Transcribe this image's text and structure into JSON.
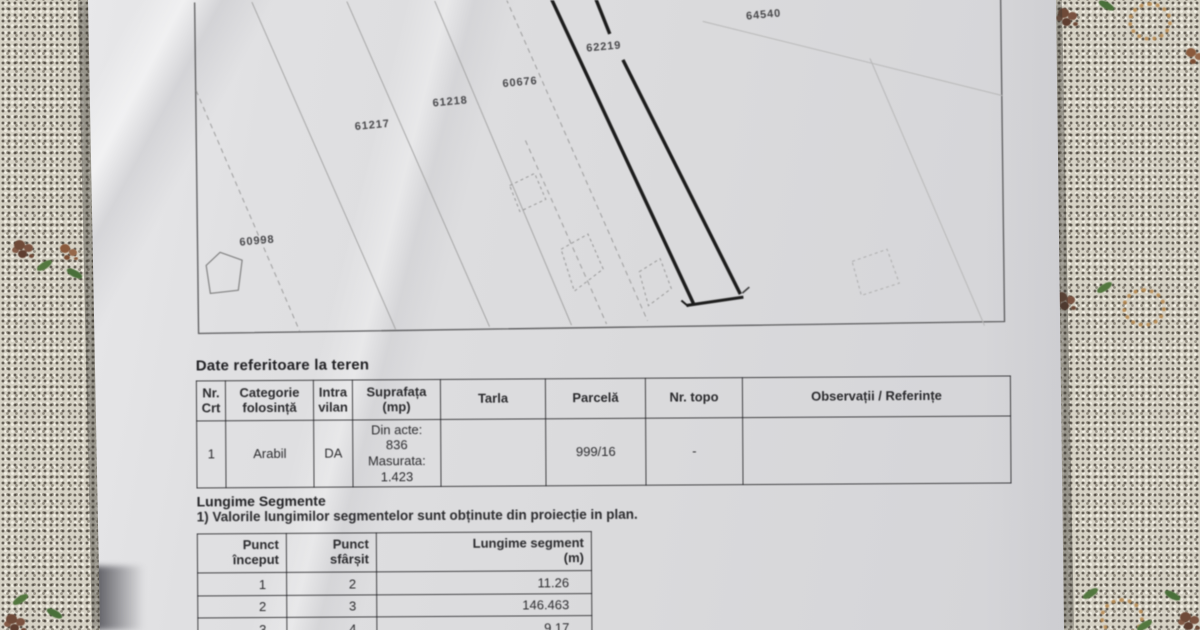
{
  "colors": {
    "ink": "#2b2b2e",
    "paper": "#dadadc",
    "cloth": "#d6d2c5",
    "parcel_outline": "#1c1c1c"
  },
  "map": {
    "parcel_labels": [
      {
        "text": "64540",
        "x": 766,
        "y": 16
      },
      {
        "text": "62219",
        "x": 606,
        "y": 47
      },
      {
        "text": "60676",
        "x": 522,
        "y": 82
      },
      {
        "text": "61218",
        "x": 452,
        "y": 101
      },
      {
        "text": "61217",
        "x": 374,
        "y": 124
      },
      {
        "text": "60998",
        "x": 258,
        "y": 239
      }
    ]
  },
  "land_section": {
    "title": "Date referitoare la teren",
    "table": {
      "headers": [
        "Nr.\nCrt",
        "Categorie\nfolosință",
        "Intra\nvilan",
        "Suprafața\n(mp)",
        "Tarla",
        "Parcelă",
        "Nr. topo",
        "Observații / Referințe"
      ],
      "rows": [
        [
          "1",
          "Arabil",
          "DA",
          "Din acte:\n836\nMasurata:\n1.423",
          "",
          "999/16",
          "-",
          ""
        ]
      ]
    }
  },
  "segments_section": {
    "title": "Lungime Segmente",
    "note": "1) Valorile lungimilor segmentelor sunt obținute din proiecție in plan.",
    "table": {
      "headers": [
        "Punct\nînceput",
        "Punct\nsfârșit",
        "Lungime segment\n(m)"
      ],
      "rows": [
        [
          "1",
          "2",
          "11.26"
        ],
        [
          "2",
          "3",
          "146.463"
        ],
        [
          "3",
          "4",
          "9.17"
        ]
      ]
    }
  }
}
